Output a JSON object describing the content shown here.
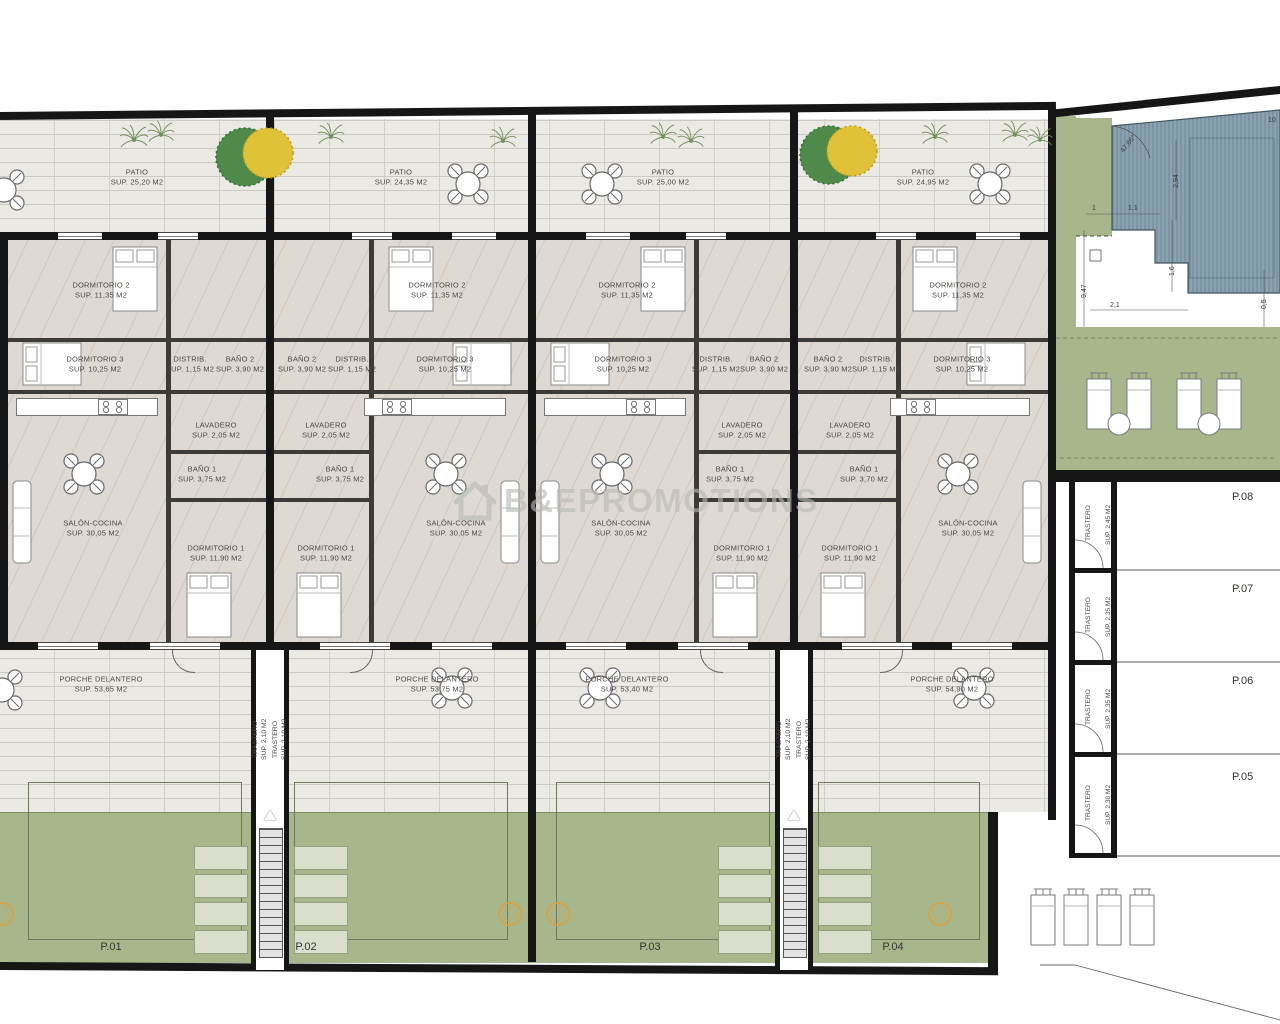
{
  "watermark": {
    "text": "B&EPROMOTIONS"
  },
  "units": [
    {
      "plot": "P.01",
      "patio_name": "PATIO",
      "patio_sup": "SUP. 25,20 M2",
      "dorm2_name": "DORMITORIO 2",
      "dorm2_sup": "SUP. 11,35 M2",
      "dorm3_name": "DORMITORIO 3",
      "dorm3_sup": "SUP. 10,25 M2",
      "distrib_name": "DISTRIB.",
      "distrib_sup": "SUP. 1,15 M2",
      "bano2_name": "BAÑO 2",
      "bano2_sup": "SUP. 3,90 M2",
      "lavadero_name": "LAVADERO",
      "lavadero_sup": "SUP. 2,05 M2",
      "bano1_name": "BAÑO 1",
      "bano1_sup": "SUP. 3,75 M2",
      "salon_name": "SALÓN-COCINA",
      "salon_sup": "SUP. 30,05 M2",
      "dorm1_name": "DORMITORIO 1",
      "dorm1_sup": "SUP. 11,90 M2",
      "porche_name": "PORCHE DELANTERO",
      "porche_sup": "SUP. 53,65 M2"
    },
    {
      "plot": "P.02",
      "patio_name": "PATIO",
      "patio_sup": "SUP. 24,35 M2",
      "dorm2_name": "DORMITORIO 2",
      "dorm2_sup": "SUP. 11,35 M2",
      "dorm3_name": "DORMITORIO 3",
      "dorm3_sup": "SUP. 10,25 M2",
      "distrib_name": "DISTRIB.",
      "distrib_sup": "SUP. 1,15 M2",
      "bano2_name": "BAÑO 2",
      "bano2_sup": "SUP. 3,90 M2",
      "lavadero_name": "LAVADERO",
      "lavadero_sup": "SUP. 2,05 M2",
      "bano1_name": "BAÑO 1",
      "bano1_sup": "SUP. 3,75 M2",
      "salon_name": "SALÓN-COCINA",
      "salon_sup": "SUP. 30,05 M2",
      "dorm1_name": "DORMITORIO 1",
      "dorm1_sup": "SUP. 11,90 M2",
      "porche_name": "PORCHE DELANTERO",
      "porche_sup": "SUP. 53,75 M2"
    },
    {
      "plot": "P.03",
      "patio_name": "PATIO",
      "patio_sup": "SUP. 25,00 M2",
      "dorm2_name": "DORMITORIO 2",
      "dorm2_sup": "SUP. 11,35 M2",
      "dorm3_name": "DORMITORIO 3",
      "dorm3_sup": "SUP. 10,25 M2",
      "distrib_name": "DISTRIB.",
      "distrib_sup": "SUP. 1,15 M2",
      "bano2_name": "BAÑO 2",
      "bano2_sup": "SUP. 3,90 M2",
      "lavadero_name": "LAVADERO",
      "lavadero_sup": "SUP. 2,05 M2",
      "bano1_name": "BAÑO 1",
      "bano1_sup": "SUP. 3,75 M2",
      "salon_name": "SALÓN-COCINA",
      "salon_sup": "SUP. 30,05 M2",
      "dorm1_name": "DORMITORIO 1",
      "dorm1_sup": "SUP. 11,90 M2",
      "porche_name": "PORCHE DELANTERO",
      "porche_sup": "SUP. 53,40 M2"
    },
    {
      "plot": "P.04",
      "patio_name": "PATIO",
      "patio_sup": "SUP. 24,95 M2",
      "dorm2_name": "DORMITORIO 2",
      "dorm2_sup": "SUP. 11,35 M2",
      "dorm3_name": "DORMITORIO 3",
      "dorm3_sup": "SUP. 10,25 M2",
      "distrib_name": "DISTRIB.",
      "distrib_sup": "SUP. 1,15 M2",
      "bano2_name": "BAÑO 2",
      "bano2_sup": "SUP. 3,90 M2",
      "lavadero_name": "LAVADERO",
      "lavadero_sup": "SUP. 2,05 M2",
      "bano1_name": "BAÑO 1",
      "bano1_sup": "SUP. 3,70 M2",
      "salon_name": "SALÓN-COCINA",
      "salon_sup": "SUP. 30,05 M2",
      "dorm1_name": "DORMITORIO 1",
      "dorm1_sup": "SUP. 11,90 M2",
      "porche_name": "PORCHE DELANTERO",
      "porche_sup": "SUP. 54,90 M2"
    }
  ],
  "stair_storage": {
    "name": "TRASTERO",
    "sup": "SUP. 2,10 M2"
  },
  "storage_units": [
    {
      "plot": "P.08",
      "name": "TRASTERO",
      "sup": "SUP. 2,45 M2"
    },
    {
      "plot": "P.07",
      "name": "TRASTERO",
      "sup": "SUP. 2,35 M2"
    },
    {
      "plot": "P.06",
      "name": "TRASTERO",
      "sup": "SUP. 2,35 M2"
    },
    {
      "plot": "P.05",
      "name": "TRASTERO",
      "sup": "SUP. 2,30 M2"
    }
  ],
  "dimensions": {
    "pool_angle": "47,66°",
    "pool_width": "2,94",
    "offset_one": "1",
    "offset_one_one": "1,1",
    "pool_step": "1,6",
    "side_depth": "9,47",
    "side_width": "2,1",
    "edge_gap": "0,5",
    "solarium_width": "9,63",
    "solarium_depth_left": "4,16",
    "solarium_depth_right": "4,16",
    "solarium_bottom": "6,56",
    "top_right_partial": "10"
  },
  "colors": {
    "wall": "#161616",
    "garden_green": "#a8b68c",
    "pool_blue": "#8ba3b0",
    "patio_floor": "#ebe9e4",
    "room_floor": "#ded9d2",
    "accent_orange": "#dda23e"
  }
}
